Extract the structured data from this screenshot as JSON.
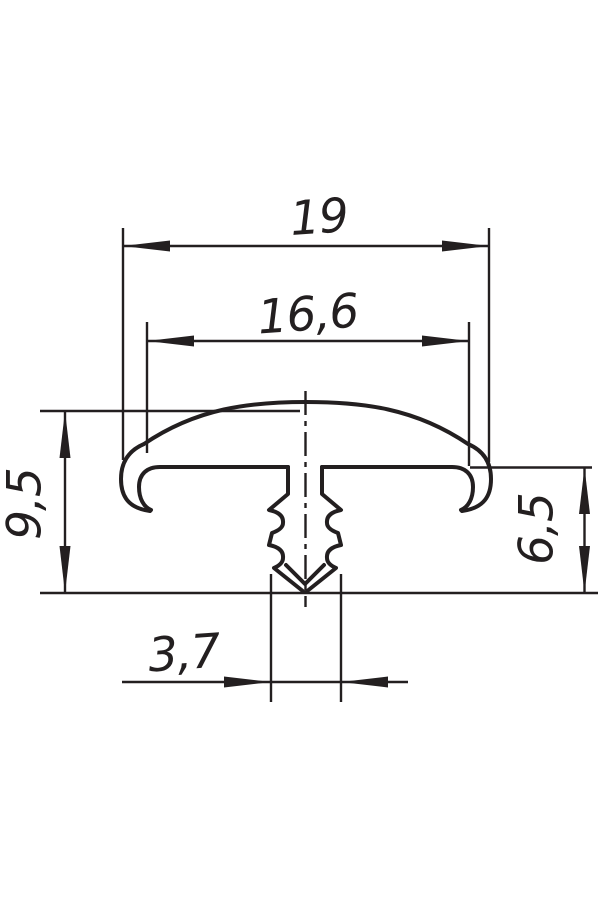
{
  "drawing": {
    "background_color": "#ffffff",
    "line_color": "#231f20",
    "dimensions": {
      "overall_width": {
        "label": "19",
        "value": 19
      },
      "cap_inner_width": {
        "label": "16,6",
        "value": 16.6
      },
      "overall_height": {
        "label": "9,5",
        "value": 9.5
      },
      "stem_height": {
        "label": "6,5",
        "value": 6.5
      },
      "barb_width": {
        "label": "3,7",
        "value": 3.7
      }
    }
  }
}
